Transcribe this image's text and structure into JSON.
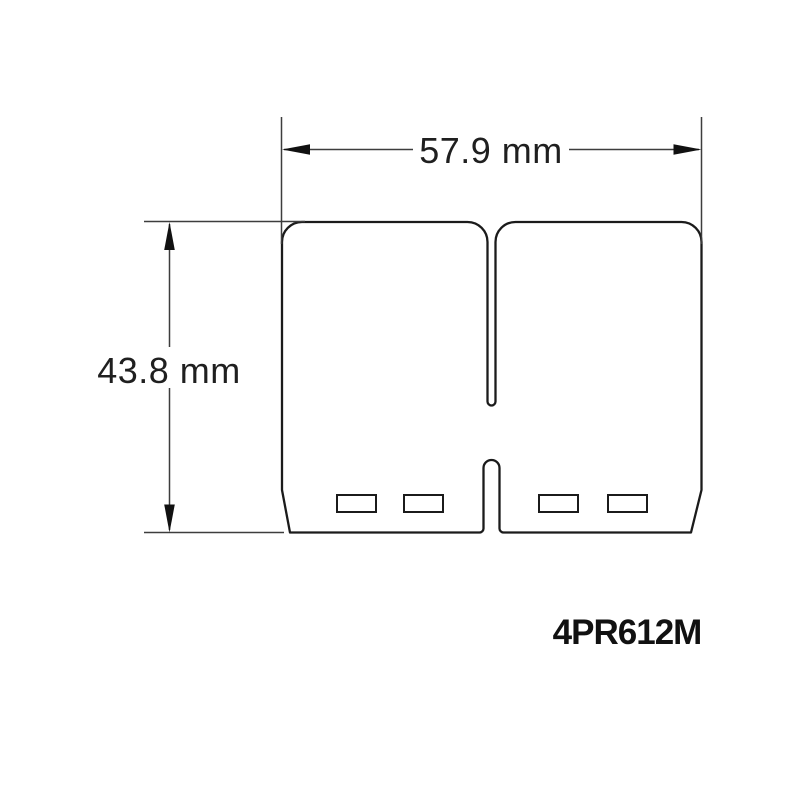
{
  "diagram": {
    "part_number": "4PR612M",
    "dimensions": {
      "width": {
        "label": "57.9 mm",
        "value": 57.9,
        "unit": "mm"
      },
      "height": {
        "label": "43.8 mm",
        "value": 43.8,
        "unit": "mm"
      }
    },
    "colors": {
      "background": "#ffffff",
      "outline_ink": "#1b1b1b",
      "dimension_ink": "#3d3d3d",
      "text_ink": "#1f1f1f"
    }
  }
}
